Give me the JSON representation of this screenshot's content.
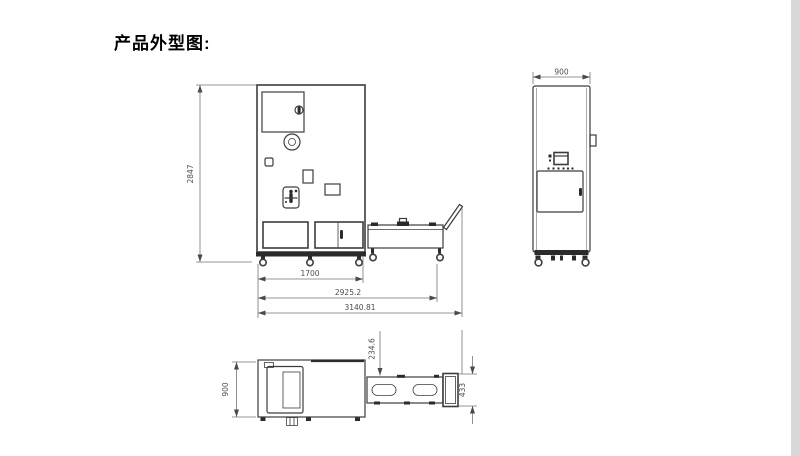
{
  "page": {
    "title": "产品外型图:",
    "background": "#ffffff",
    "line_color": "#3d3d3d",
    "dim_text_color": "#4d4d4d"
  },
  "drawing": {
    "front_view": {
      "dims": {
        "overall_height": "2847",
        "cabinet_width": "1700",
        "width_with_trolley": "2925.2",
        "overall_width": "3140.81"
      }
    },
    "side_view": {
      "dims": {
        "depth": "900"
      }
    },
    "top_view": {
      "dims": {
        "depth": "900",
        "trolley_offset": "234.6",
        "trolley_width": "433"
      }
    }
  }
}
